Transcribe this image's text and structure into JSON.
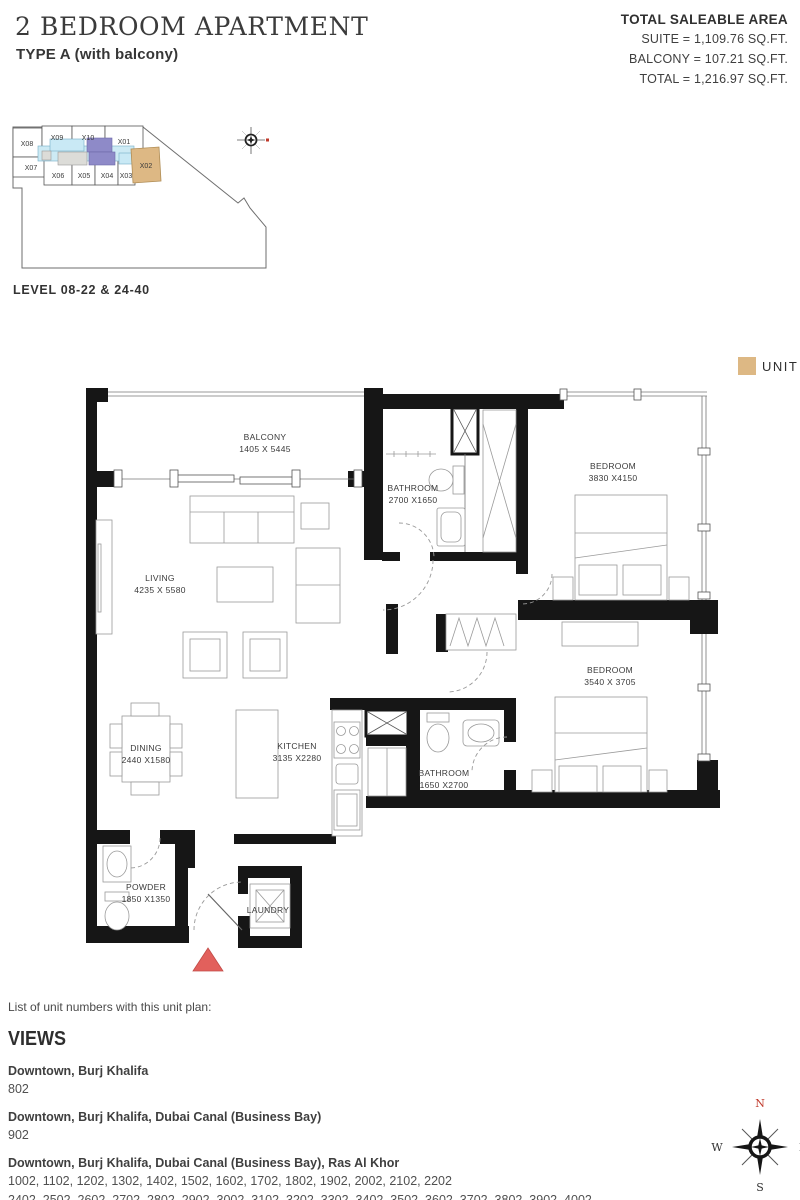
{
  "header": {
    "title": "2 BEDROOM APARTMENT",
    "subtitle": "TYPE A (with balcony)"
  },
  "saleable_area": {
    "heading": "TOTAL SALEABLE AREA",
    "suite": "SUITE = 1,109.76 SQ.FT.",
    "balcony": "BALCONY = 107.21 SQ.FT.",
    "total": "TOTAL = 1,216.97 SQ.FT."
  },
  "keyplan": {
    "level_label": "LEVEL 08-22 & 24-40",
    "highlight_unit": "X02",
    "units": [
      {
        "id": "X08"
      },
      {
        "id": "X09"
      },
      {
        "id": "X10"
      },
      {
        "id": "X01"
      },
      {
        "id": "X07"
      },
      {
        "id": "X06"
      },
      {
        "id": "X05"
      },
      {
        "id": "X04"
      },
      {
        "id": "X03"
      },
      {
        "id": "X02"
      }
    ]
  },
  "legend": {
    "unit_label": "UNIT",
    "unit_color": "#ddb884"
  },
  "floorplan": {
    "rooms": [
      {
        "name": "BALCONY",
        "dims": "1405 X 5445"
      },
      {
        "name": "LIVING",
        "dims": "4235 X 5580"
      },
      {
        "name": "BATHROOM",
        "dims": "2700 X1650"
      },
      {
        "name": "BEDROOM",
        "dims": "3830 X4150"
      },
      {
        "name": "BEDROOM",
        "dims": "3540 X 3705"
      },
      {
        "name": "BATHROOM",
        "dims": "1650 X2700"
      },
      {
        "name": "KITCHEN",
        "dims": "3135 X2280"
      },
      {
        "name": "DINING",
        "dims": "2440 X1580"
      },
      {
        "name": "POWDER",
        "dims": "1850 X1350"
      },
      {
        "name": "LAUNDRY",
        "dims": ""
      }
    ]
  },
  "views": {
    "intro": "List of unit numbers with this unit plan:",
    "heading": "VIEWS",
    "groups": [
      {
        "name": "Downtown, Burj Khalifa",
        "lines": [
          "802"
        ]
      },
      {
        "name": "Downtown, Burj Khalifa, Dubai Canal (Business Bay)",
        "lines": [
          "902"
        ]
      },
      {
        "name": "Downtown, Burj Khalifa, Dubai Canal (Business Bay), Ras Al Khor",
        "lines": [
          "1002, 1102, 1202, 1302, 1402, 1502, 1602, 1702, 1802, 1902, 2002, 2102, 2202",
          "2402, 2502, 2602, 2702, 2802, 2902, 3002, 3102, 3202, 3302, 3402, 3502, 3602, 3702, 3802, 3902, 4002"
        ]
      }
    ]
  },
  "compass": {
    "north": "N",
    "east": "E",
    "south": "S",
    "west": "W"
  },
  "colors": {
    "unit_highlight": "#ddb884",
    "corridor_blue": "#cdeaf4",
    "core_purple": "#8e8ac8",
    "entrance_red": "#e2605c",
    "wall_black": "#161616"
  }
}
